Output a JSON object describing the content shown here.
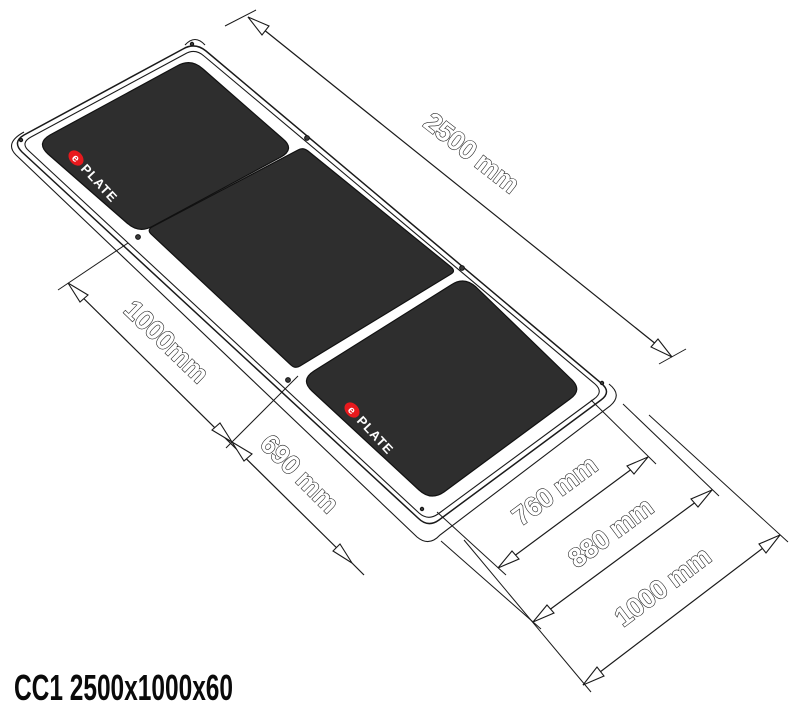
{
  "title": "CC1 2500x1000x60",
  "brand": {
    "dot_letter": "e",
    "name": "PLATE"
  },
  "colors": {
    "panel": "#2e2e2e",
    "line": "#1a1a1a",
    "logo_red": "#e8191d",
    "background": "#ffffff"
  },
  "dimensions": {
    "length": "2500 mm",
    "mid_panel_length": "1000mm",
    "end_panel_length": "690 mm",
    "end_panel_width": "760 mm",
    "mid_panel_width": "880 mm",
    "overall_width": "1000 mm"
  }
}
